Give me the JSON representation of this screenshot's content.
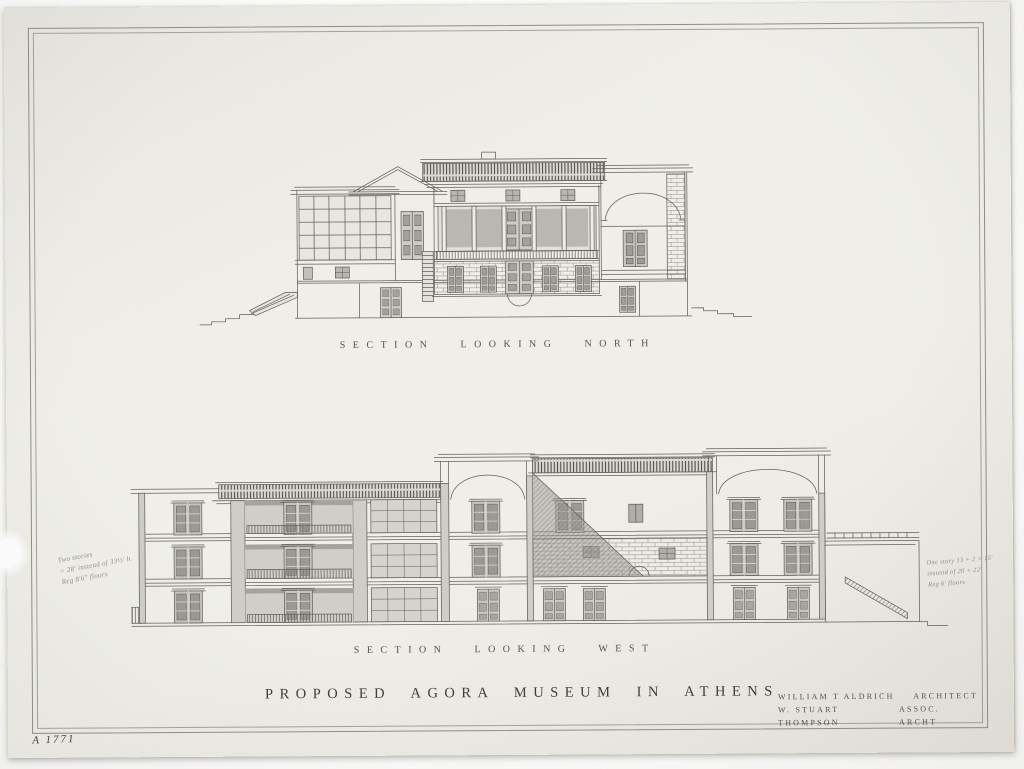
{
  "artwork": {
    "type": "architectural section drawing, photographed sheet",
    "labels": {
      "section_north": "SECTION LOOKING NORTH",
      "section_west": "SECTION LOOKING WEST",
      "title": "PROPOSED AGORA MUSEUM IN ATHENS"
    },
    "credits": {
      "architect_name": "WILLIAM T ALDRICH",
      "architect_role": "ARCHITECT",
      "associate_name": "W. STUART THOMPSON",
      "associate_role": "ASSOC. ARCHT"
    },
    "annotations": {
      "left_note_line1": "Two stories",
      "left_note_line2": "= 28' instead of 33½' h.",
      "left_note_line3": "Reg 8'6\" floors",
      "right_note_line1": "One story 13 + 2 = 15'",
      "right_note_line2": "instead of 20 + 22'",
      "right_note_line3": "Reg 6' floors",
      "catalog_number": "A 1771"
    },
    "colors": {
      "paper": "#efeee9",
      "ink_line": "#63625c",
      "ink_dark": "#4e4d47",
      "shade_light": "#d0cfc7",
      "shade_dark": "#9b9a92",
      "pencil": "#8f8e86"
    }
  }
}
